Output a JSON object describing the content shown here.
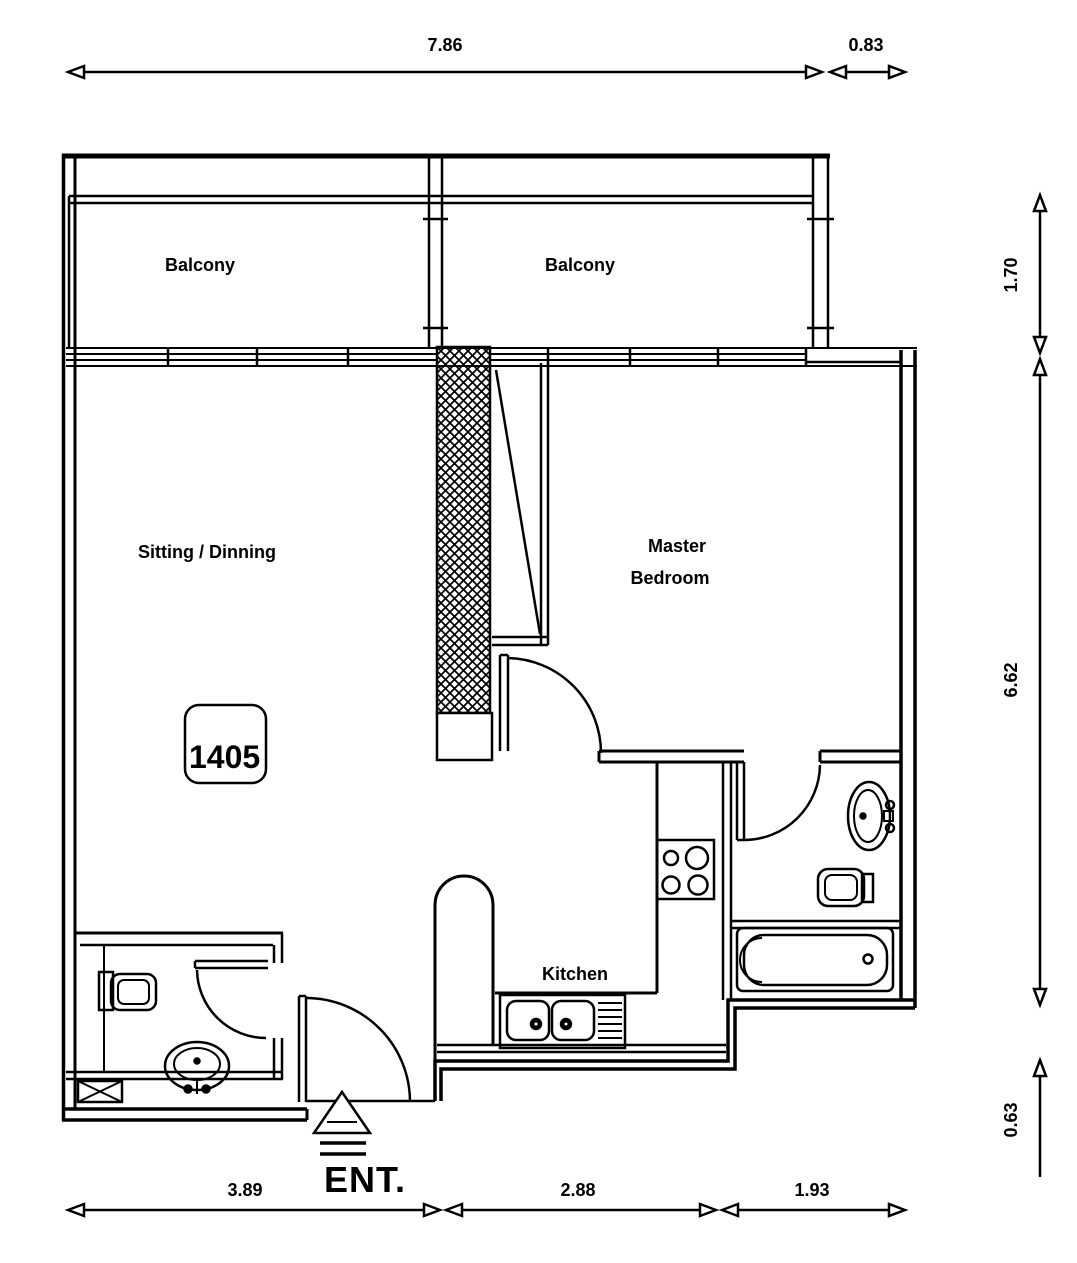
{
  "title": "Apartment floor plan",
  "rooms": {
    "balcony_left": "Balcony",
    "balcony_right": "Balcony",
    "sitting": "Sitting / Dinning",
    "master_line1": "Master",
    "master_line2": "Bedroom",
    "kitchen": "Kitchen"
  },
  "unit": {
    "number": "1405"
  },
  "entrance": {
    "label": "ENT."
  },
  "dimensions": {
    "top": [
      "7.86",
      "0.83"
    ],
    "bottom": [
      "3.89",
      "2.88",
      "1.93"
    ],
    "right": [
      "1.70",
      "6.62",
      "0.63"
    ]
  },
  "colors": {
    "line": "#000000",
    "background": "#ffffff"
  }
}
